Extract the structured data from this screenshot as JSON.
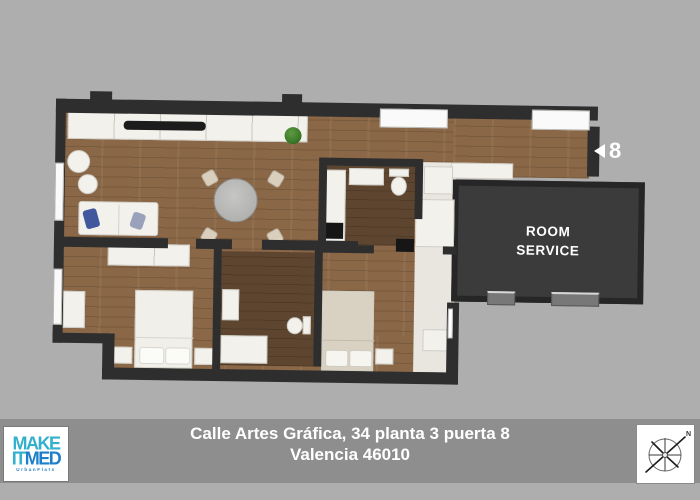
{
  "colors": {
    "background": "#aeaeae",
    "footer_band": "#8e8e8e",
    "wall": "#2e2e2e",
    "wood": "#8a6747",
    "wood_dark": "#5e452f",
    "floor_light": "#e8e6df",
    "fixture": "#f2f1ec",
    "room_service_bg": "#3b3b3b",
    "room_service_border": "#262626",
    "plant_green": "#3c7a2a",
    "pillow_blue": "#41589f",
    "logo_teal": "#33b0cd",
    "logo_blue": "#1e7fc9"
  },
  "plan": {
    "room_service_label": "ROOM SERVICE",
    "door_marker": "8"
  },
  "footer": {
    "address_line1": "Calle Artes Gráfica, 34 planta 3 puerta 8",
    "address_line2": "Valencia  46010"
  },
  "logo": {
    "line1": "MAKE",
    "line2_part1": "IT",
    "line2_part2": "MED",
    "tagline": "UrbanFlats"
  },
  "compass": {
    "north_label": "N"
  }
}
